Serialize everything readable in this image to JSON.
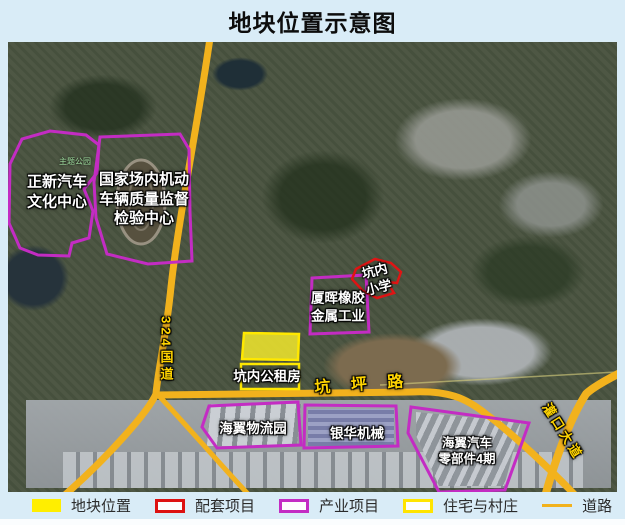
{
  "title": "地块位置示意图",
  "map": {
    "labels": {
      "zhengxin": "正新汽车\n文化中心",
      "national_center": "国家场内机动\n车辆质量监督\n检验中心",
      "theme_park": "主题公园",
      "xiahui": "厦晖橡胶\n金属工业",
      "kengnei_school": "坑内\n小学",
      "gongzufang": "坑内公租房",
      "kengping_road": "坑 坪 路",
      "haiyi_logistics": "海翼物流园",
      "yinhua": "银华机械",
      "haiyi_parts": "海翼汽车\n零部件4期",
      "g324": "324国道",
      "guankou": "灌口大道"
    }
  },
  "legend": {
    "items": [
      {
        "label": "地块位置",
        "swatch": "yellow-fill"
      },
      {
        "label": "配套项目",
        "swatch": "red-outline"
      },
      {
        "label": "产业项目",
        "swatch": "purple-outline"
      },
      {
        "label": "住宅与村庄",
        "swatch": "yellow-outline"
      },
      {
        "label": "道路",
        "swatch": "yellow-line"
      }
    ]
  },
  "colors": {
    "background": "#d9ecf7",
    "plot_yellow": "#ffee00",
    "supporting_red": "#dd1111",
    "industrial_purple": "#c32cc3",
    "residential_yellow": "#ffe400",
    "road_yellow": "#f2b21d",
    "road_label_yellow": "#ffd400"
  }
}
